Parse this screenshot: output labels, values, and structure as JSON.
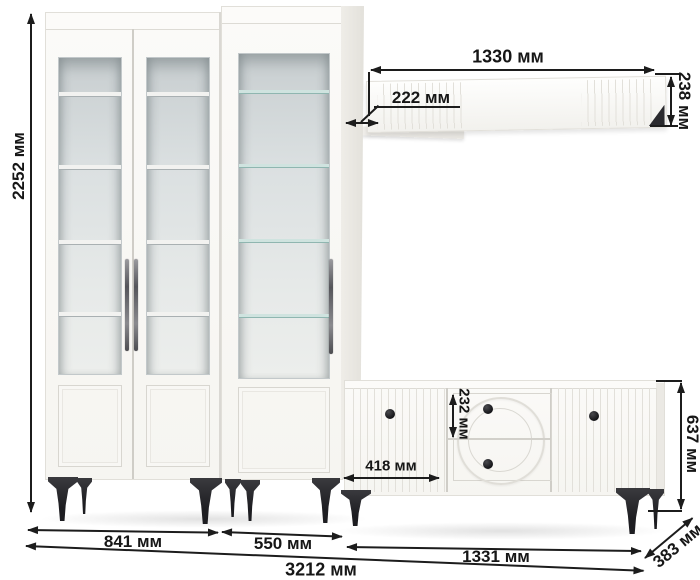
{
  "diagram": {
    "type": "furniture-dimension-diagram",
    "unit": "мм"
  },
  "dims": {
    "total_height": "2252 мм",
    "shelf_width": "1330 мм",
    "shelf_depth": "222 мм",
    "shelf_height": "238 мм",
    "drawer_height": "232 мм",
    "tv_door_width": "418 мм",
    "tv_height": "637 мм",
    "left_cabinet_width": "841 мм",
    "right_cabinet_width": "550 мм",
    "tv_width": "1331 мм",
    "tv_depth": "383 мм",
    "total_width": "3212 мм"
  },
  "values_mm": {
    "total_height": 2252,
    "shelf_width": 1330,
    "shelf_depth": 222,
    "shelf_height": 238,
    "drawer_height": 232,
    "tv_door_width": 418,
    "tv_height": 637,
    "left_cabinet_width": 841,
    "right_cabinet_width": 550,
    "tv_width": 1331,
    "tv_depth": 383,
    "total_width": 3212
  },
  "colors": {
    "dimension_line": "#1c1c1c",
    "furniture_white": "#f8f7f4",
    "glass": "#dde2e3",
    "glass_shelf_tint": "#cfe3df",
    "legs": "#28282b",
    "knobs": "#1c1c20",
    "background": "#ffffff"
  }
}
